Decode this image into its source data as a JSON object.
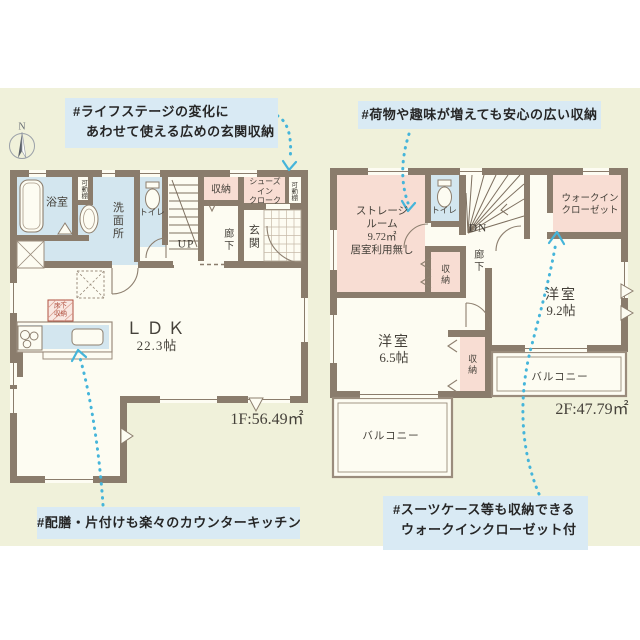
{
  "colors": {
    "background": "#ffffff",
    "panel": "#f0f1da",
    "wall": "#8a7c6c",
    "room": "#fdfcf2",
    "water_room_blue": "#d3e6ef",
    "storage_pink": "#f8ddd3",
    "callout_bg": "#d9eaf4",
    "arrow_cyan": "#45b5da",
    "stamp_red": "#b05040",
    "text": "#45413a"
  },
  "compass": {
    "north": "N"
  },
  "callouts": {
    "entrance": [
      "#ライフステージの変化に",
      "あわせて使える広めの玄関収納"
    ],
    "storage": [
      "#荷物や趣味が増えても安心の広い収納"
    ],
    "kitchen": [
      "#配膳・片付けも楽々のカウンターキッチン"
    ],
    "wic": [
      "#スーツケース等も収納できる",
      "ウォークインクローゼット付"
    ]
  },
  "floor1": {
    "area": "1F:56.49㎡",
    "bath": "浴室",
    "movable_shelf_left": "可動棚",
    "washroom": "洗面所",
    "toilet": "トイレ",
    "stairs": "UP",
    "closet": "収納",
    "shoes_closet": [
      "シューズ",
      "イン",
      "クローク"
    ],
    "movable_shelf_right": "可動棚",
    "entrance": "玄関",
    "hallway": "廊下",
    "ldk": [
      "ＬＤＫ",
      "22.3帖"
    ],
    "floor_storage": [
      "床下",
      "収納"
    ]
  },
  "floor2": {
    "area": "2F:47.79㎡",
    "storage_room": [
      "ストレージ",
      "ルーム",
      "9.72㎡",
      "居室利用無し"
    ],
    "toilet": "トイレ",
    "stairs": "DN",
    "walk_in_closet": [
      "ウォークイン",
      "クローゼット"
    ],
    "hallway": "廊下",
    "closet_upper": "収納",
    "closet_lower": "収納",
    "room_65": [
      "洋室",
      "6.5帖"
    ],
    "room_92": [
      "洋室",
      "9.2帖"
    ],
    "balcony_left": "バルコニー",
    "balcony_right": "バルコニー"
  }
}
